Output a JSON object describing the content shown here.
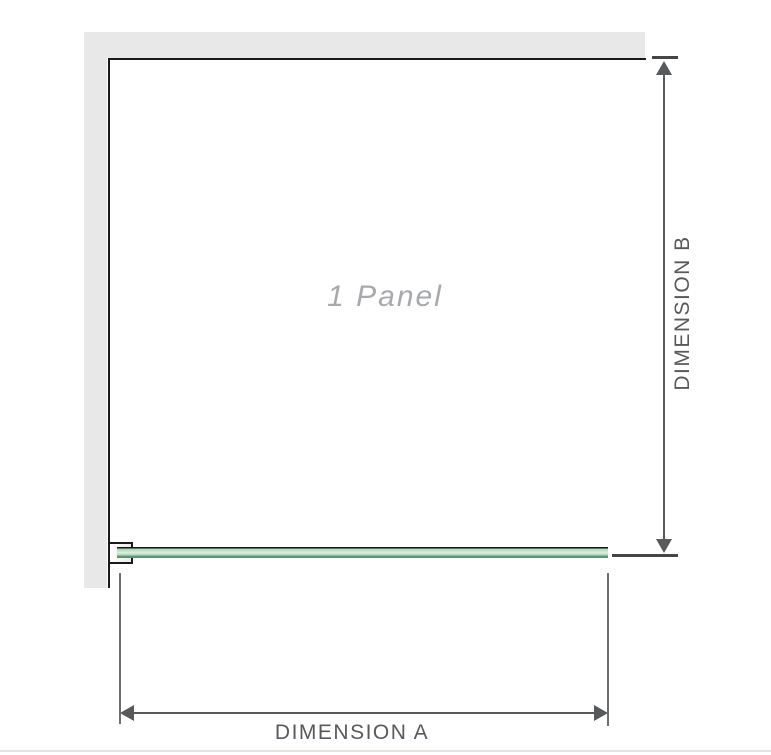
{
  "diagram": {
    "panel_label": "1 Panel",
    "dimension_a_label": "DIMENSION A",
    "dimension_b_label": "DIMENSION B"
  },
  "colors": {
    "wall": "#e8e8e8",
    "outline": "#1a1a1a",
    "dimension": "#58595b",
    "extension": "#6d6e71",
    "panel_text": "#a7a9ac",
    "glass_green": "#a3d5ae",
    "glass_highlight": "#daf0df",
    "glass_edge": "#648f6e",
    "baseline": "#e7e4e0"
  }
}
